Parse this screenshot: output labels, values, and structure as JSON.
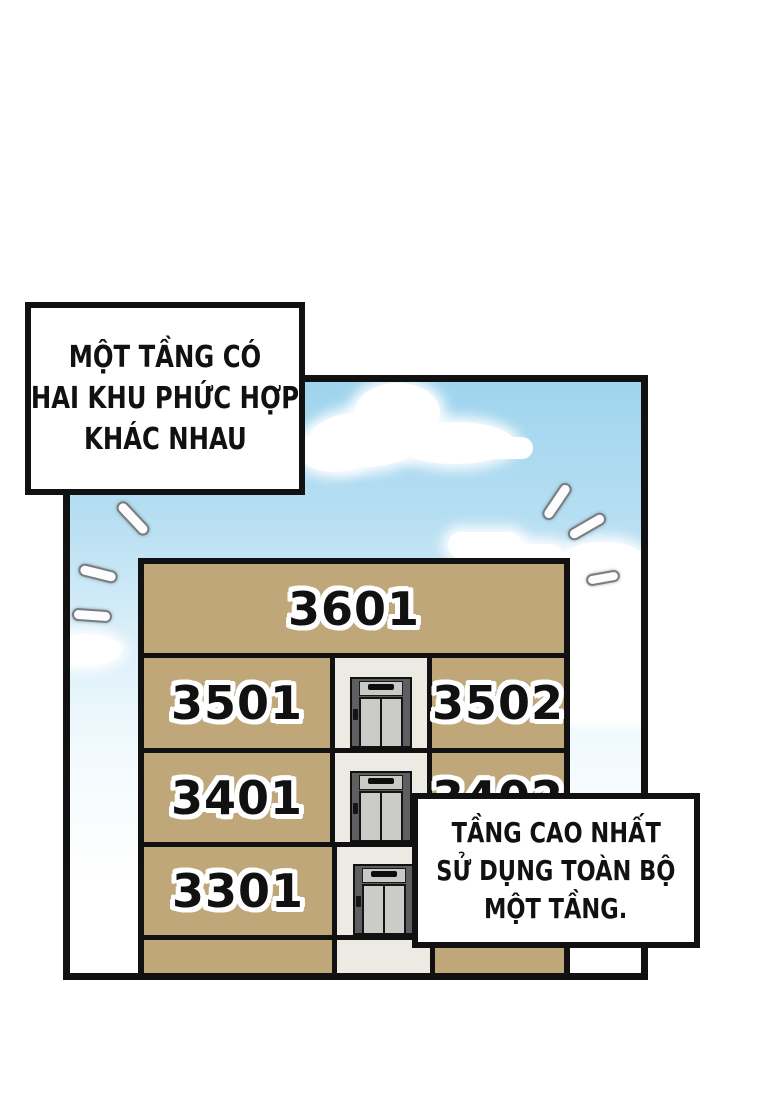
{
  "bubbles": {
    "top_left": {
      "lines": [
        "MỘT TẦNG CÓ",
        "HAI KHU PHỨC HỢP",
        "KHÁC NHAU"
      ]
    },
    "bottom_right": {
      "lines": [
        "TẦNG CAO NHẤT",
        "SỬ DỤNG TOÀN BỘ",
        "MỘT TẦNG."
      ]
    }
  },
  "building": {
    "floors": [
      {
        "label": "3601"
      },
      {
        "left": "3501",
        "right": "3502"
      },
      {
        "left": "3401",
        "right": "3402"
      },
      {
        "left": "3301",
        "right": ""
      }
    ]
  },
  "colors": {
    "wall": "#bfa77a",
    "outline": "#111111",
    "sky_top": "#9fd4ee",
    "sky_bottom": "#ffffff",
    "elevator_frame": "#5e5f60",
    "elevator_door": "#cbcbc8",
    "elevator_shaft_bg": "#eceae3",
    "bubble_bg": "#ffffff",
    "text": "#111111"
  }
}
